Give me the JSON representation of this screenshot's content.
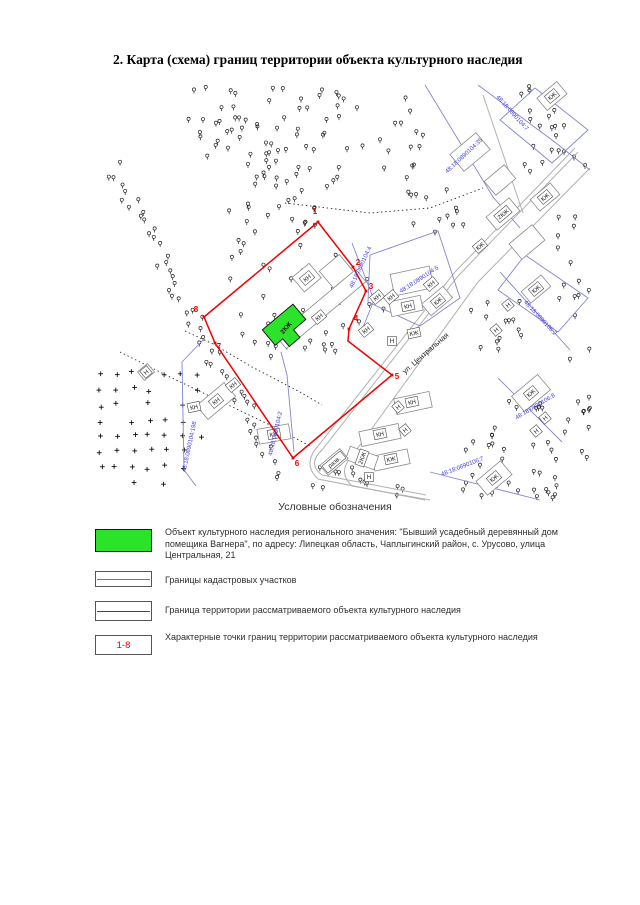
{
  "page": {
    "title": "2.  Карта (схема) границ территории объекта культурного наследия"
  },
  "map": {
    "street_label": {
      "text": "ул. Центральная",
      "x": 427,
      "y": 355,
      "rot": -41
    },
    "boundary_points": [
      {
        "n": "1",
        "x": 315,
        "y": 214
      },
      {
        "n": "2",
        "x": 358,
        "y": 265
      },
      {
        "n": "3",
        "x": 371,
        "y": 289
      },
      {
        "n": "4",
        "x": 356,
        "y": 321
      },
      {
        "n": "5",
        "x": 397,
        "y": 379
      },
      {
        "n": "6",
        "x": 297,
        "y": 466
      },
      {
        "n": "7",
        "x": 219,
        "y": 349
      },
      {
        "n": "8",
        "x": 196,
        "y": 312
      }
    ],
    "cadastral_labels": [
      {
        "text": "48:18:0890104:4",
        "x": 362,
        "y": 268,
        "rot": -65
      },
      {
        "text": "48:18:0890104:5",
        "x": 420,
        "y": 281,
        "rot": -33
      },
      {
        "text": "48:18:0890104:7",
        "x": 511,
        "y": 114,
        "rot": 48
      },
      {
        "text": "48:18:0890104:35",
        "x": 465,
        "y": 157,
        "rot": -43
      },
      {
        "text": "48:18:0890104:198",
        "x": 191,
        "y": 447,
        "rot": -78
      },
      {
        "text": "48:18:0890104:2",
        "x": 277,
        "y": 434,
        "rot": -77
      },
      {
        "text": "48:18:0890106:2",
        "x": 539,
        "y": 319,
        "rot": 47
      },
      {
        "text": "48:18:0890106:7",
        "x": 463,
        "y": 468,
        "rot": -21
      },
      {
        "text": "48:18:0890106:8",
        "x": 536,
        "y": 408,
        "rot": -31
      }
    ],
    "object_label": {
      "text": "2КЖ",
      "x": 286,
      "y": 328,
      "rot": -50
    },
    "building_labels": [
      {
        "text": "КН",
        "x": 307,
        "y": 278,
        "rot": -40
      },
      {
        "text": "КН",
        "x": 319,
        "y": 317,
        "rot": -40
      },
      {
        "text": "КН",
        "x": 377,
        "y": 297,
        "rot": -40
      },
      {
        "text": "КН",
        "x": 391,
        "y": 297,
        "rot": -40
      },
      {
        "text": "КН",
        "x": 408,
        "y": 306,
        "rot": -12
      },
      {
        "text": "КН",
        "x": 431,
        "y": 284,
        "rot": -40
      },
      {
        "text": "КЖ",
        "x": 438,
        "y": 301,
        "rot": -40
      },
      {
        "text": "КН",
        "x": 366,
        "y": 330,
        "rot": -40
      },
      {
        "text": "КЖ",
        "x": 414,
        "y": 333,
        "rot": -12
      },
      {
        "text": "Н",
        "x": 392,
        "y": 341,
        "rot": 0
      },
      {
        "text": "КЖ",
        "x": 552,
        "y": 96,
        "rot": -40
      },
      {
        "text": "2КЖ",
        "x": 503,
        "y": 214,
        "rot": -40
      },
      {
        "text": "КЖ",
        "x": 545,
        "y": 197,
        "rot": -40
      },
      {
        "text": "КЖ",
        "x": 480,
        "y": 246,
        "rot": -40
      },
      {
        "text": "КЖ",
        "x": 536,
        "y": 289,
        "rot": -40
      },
      {
        "text": "Н",
        "x": 508,
        "y": 305,
        "rot": -40
      },
      {
        "text": "Н",
        "x": 496,
        "y": 330,
        "rot": -40
      },
      {
        "text": "КН",
        "x": 412,
        "y": 402,
        "rot": -12
      },
      {
        "text": "Н",
        "x": 398,
        "y": 407,
        "rot": -40
      },
      {
        "text": "КН",
        "x": 380,
        "y": 434,
        "rot": -12
      },
      {
        "text": "Н",
        "x": 405,
        "y": 430,
        "rot": -40
      },
      {
        "text": "2КЖ",
        "x": 362,
        "y": 458,
        "rot": -70
      },
      {
        "text": "КЖ",
        "x": 391,
        "y": 459,
        "rot": -12
      },
      {
        "text": "разв.",
        "x": 334,
        "y": 462,
        "rot": -40
      },
      {
        "text": "Н",
        "x": 369,
        "y": 477,
        "rot": 0
      },
      {
        "text": "КЖ",
        "x": 531,
        "y": 393,
        "rot": -40
      },
      {
        "text": "Н",
        "x": 545,
        "y": 418,
        "rot": -40
      },
      {
        "text": "Н",
        "x": 536,
        "y": 431,
        "rot": -40
      },
      {
        "text": "КЖ",
        "x": 494,
        "y": 478,
        "rot": -40
      },
      {
        "text": "КН",
        "x": 233,
        "y": 385,
        "rot": -40
      },
      {
        "text": "КН",
        "x": 216,
        "y": 401,
        "rot": -40
      },
      {
        "text": "КН",
        "x": 194,
        "y": 407,
        "rot": -12
      },
      {
        "text": "КЖ",
        "x": 274,
        "y": 434,
        "rot": -10
      },
      {
        "text": "Н",
        "x": 146,
        "y": 372,
        "rot": -40
      }
    ]
  },
  "legend": {
    "title": "Условные обозначения",
    "items": [
      {
        "text": "Объект культурного наследия регионального значения: \"Бывший усадебный деревянный дом помещика Вагнера\", по адресу: Липецкая область, Чаплыгинский район, с. Урусово, улица Центральная, 21"
      },
      {
        "text": "Границы кадастровых участков"
      },
      {
        "text": "Граница территории рассматриваемого объекта культурного наследия"
      },
      {
        "swatch_label": "1-8",
        "text": "Характерные точки границ территории рассматриваемого объекта культурного наследия"
      }
    ]
  },
  "colors": {
    "boundary_red": "#f20000",
    "cadastral_line": "#8585cf",
    "cadastral_text": "#3c3cdc",
    "object_green": "#2be32b",
    "road_gray": "#b0b0b0"
  }
}
